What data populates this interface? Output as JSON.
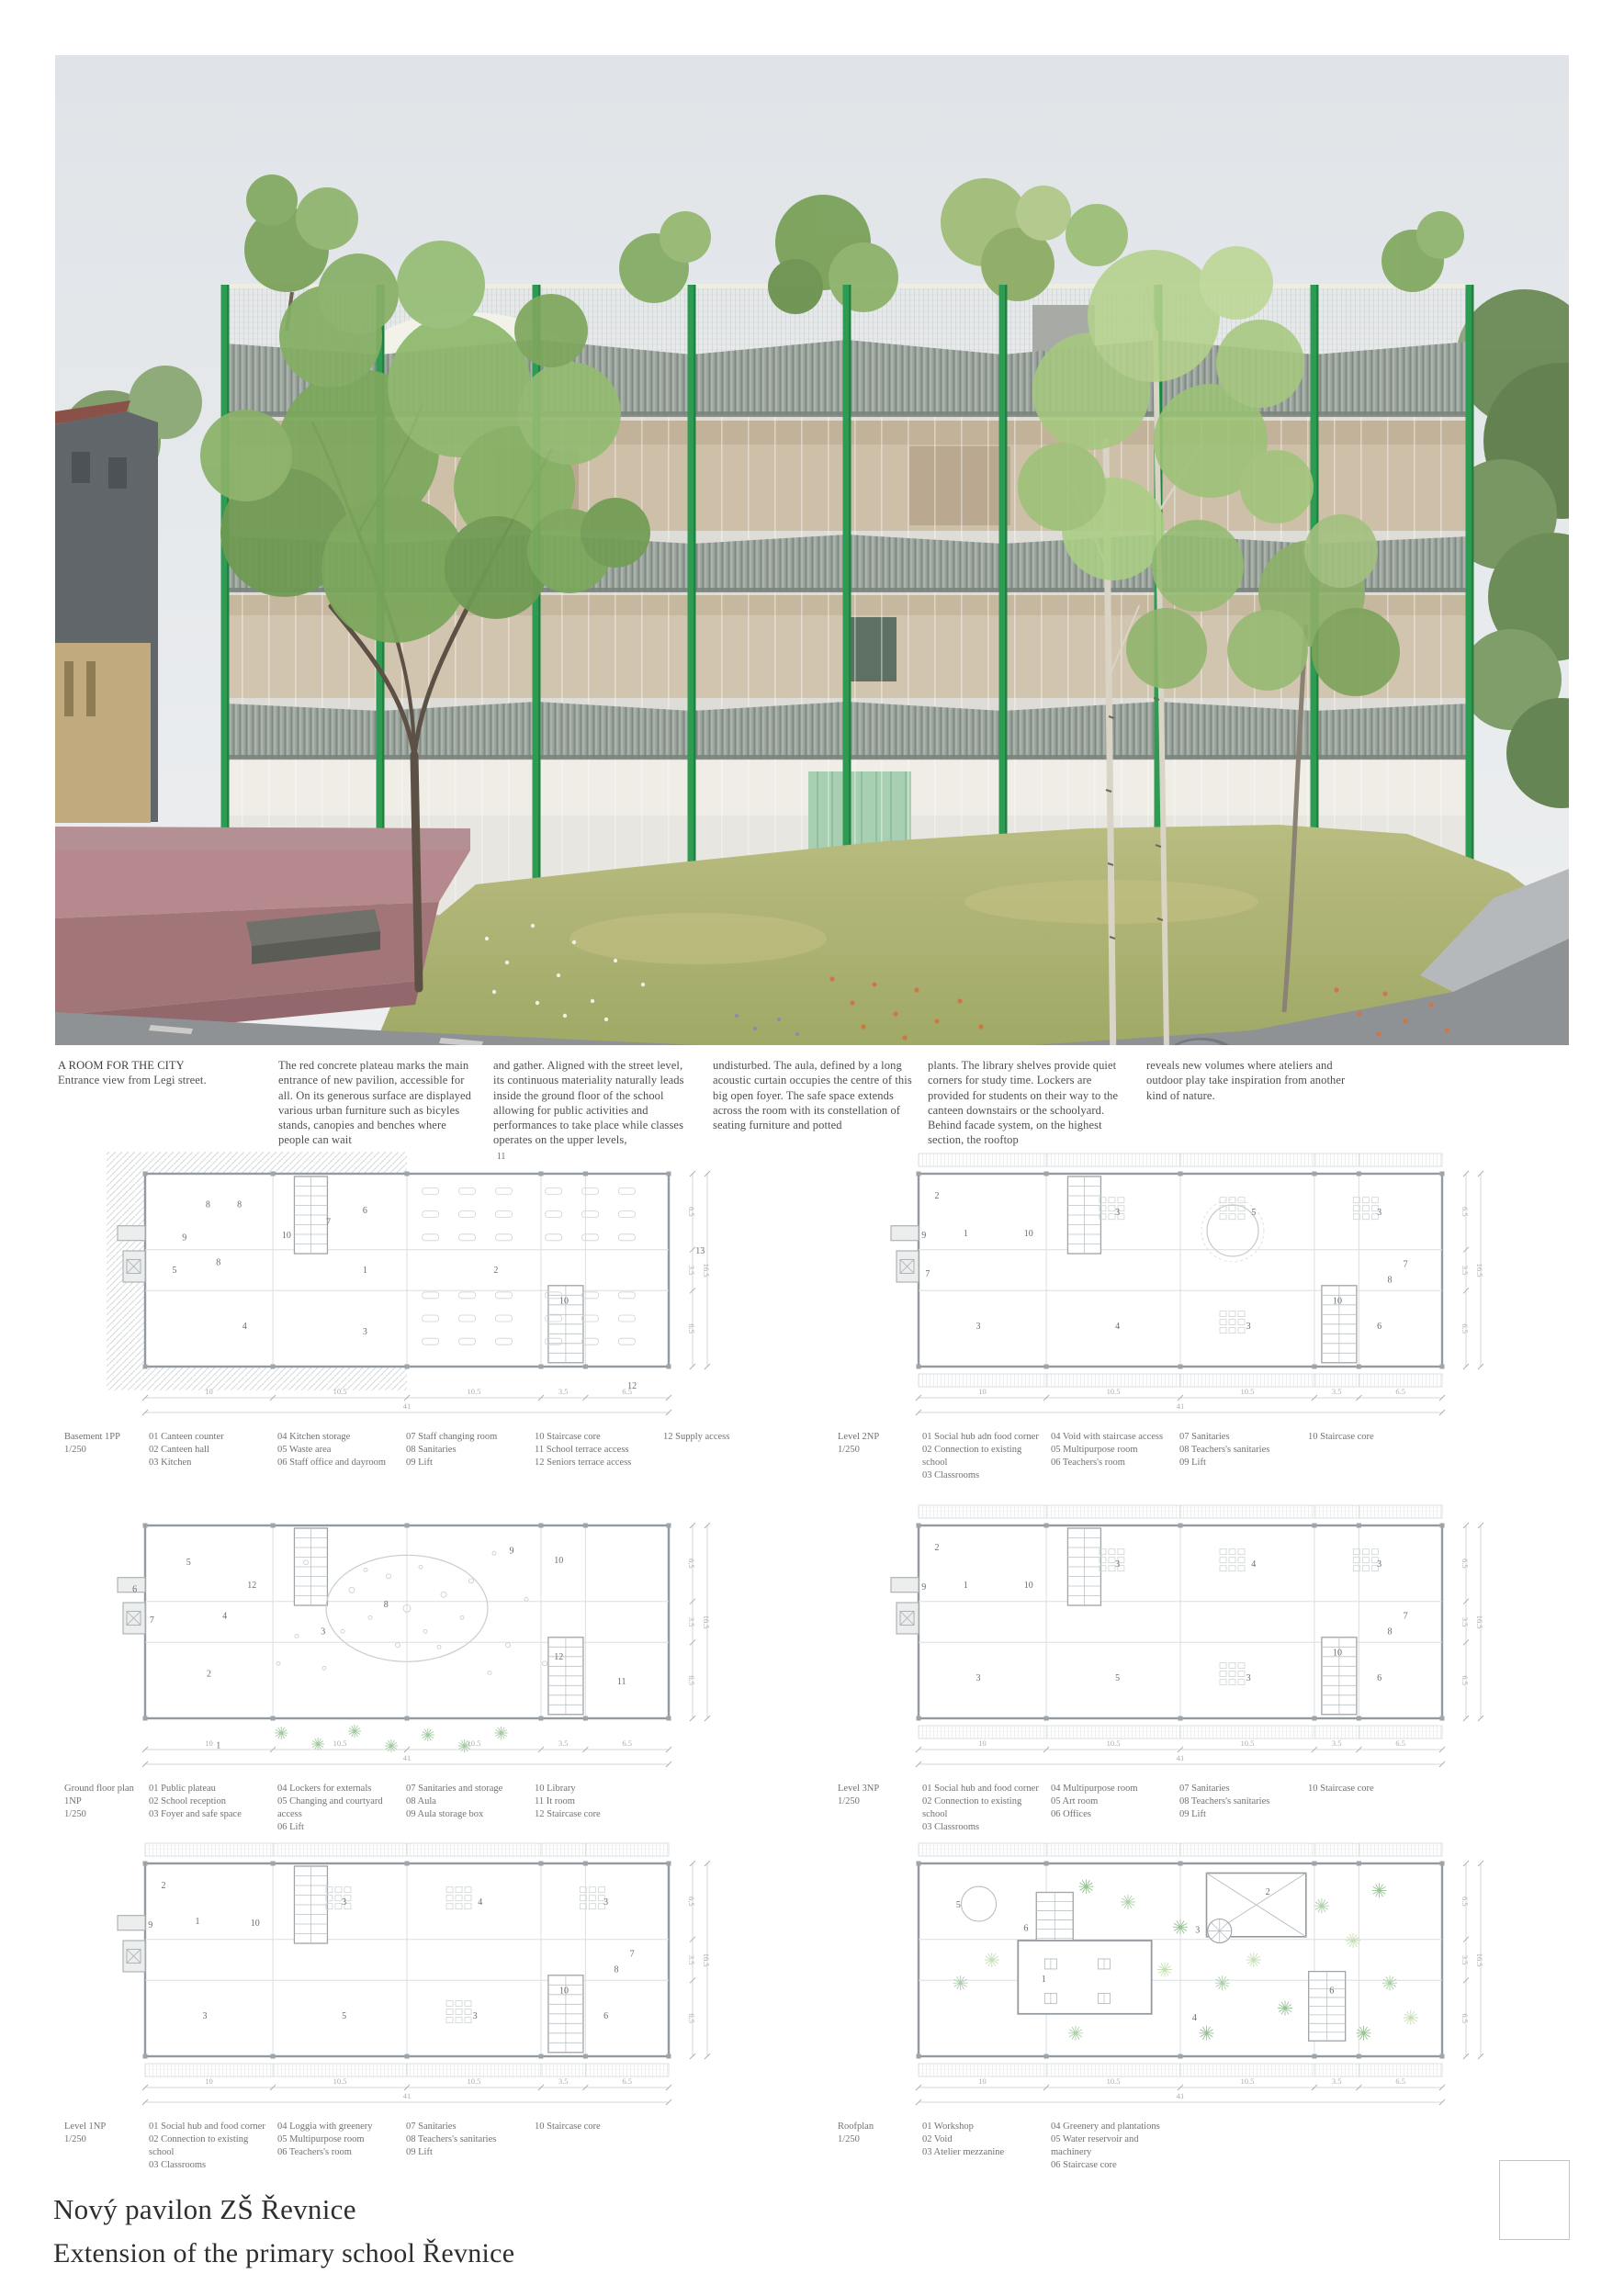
{
  "colors": {
    "structure_green": "#2e9b52",
    "plateau_red": "#b5898e",
    "awning_gray": "#99a29a",
    "grass_green": "#aab06c",
    "sky_gray": "#e0e4e8",
    "text_gray": "#4c4f52"
  },
  "hero": {
    "caption": {
      "title": "A ROOM FOR THE CITY",
      "subtitle": "Entrance view from Legi street."
    },
    "columns": [
      "The red concrete plateau marks the main entrance of new pavilion, accessible for all. On its generous surface are displayed various urban furniture such as bicyles stands, canopies and benches where people can wait",
      "and gather. Aligned with the street level, its continuous materiality naturally leads inside the ground floor of the school allowing for public activities and performances to take place while classes operates on the upper levels,",
      "undisturbed. The aula, defined by a long acoustic curtain occupies the centre of this big open foyer. The safe space extends across the room with its constellation of seating furniture and potted",
      "plants. The library shelves provide quiet corners for study time. Lockers are provided for students on their way to the canteen downstairs or the schoolyard. Behind facade system, on the highest section, the rooftop",
      "reveals new volumes where ateliers and outdoor play take inspiration from another kind of nature."
    ]
  },
  "plans": [
    {
      "label": "Basement 1PP",
      "scale": "1/250",
      "legend": [
        [
          "01 Canteen counter",
          "02 Canteen hall",
          "03 Kitchen"
        ],
        [
          "04 Kitchen storage",
          "05 Waste area",
          "06 Staff office and dayroom"
        ],
        [
          "07 Staff changing room",
          "08 Sanitaries",
          "09 Lift"
        ],
        [
          "10 Staircase core",
          "11 School terrace access",
          "12 Seniors terrace access"
        ],
        [
          "12 Supply access"
        ]
      ],
      "features": [
        "hatch-left",
        "annex-left",
        "stair-left",
        "stair-right",
        "canteen"
      ],
      "rooms": [
        {
          "n": "8",
          "x": 0.12,
          "y": 0.16
        },
        {
          "n": "8",
          "x": 0.18,
          "y": 0.16
        },
        {
          "n": "10",
          "x": 0.27,
          "y": 0.32
        },
        {
          "n": "7",
          "x": 0.35,
          "y": 0.25
        },
        {
          "n": "6",
          "x": 0.42,
          "y": 0.19
        },
        {
          "n": "9",
          "x": 0.075,
          "y": 0.33
        },
        {
          "n": "5",
          "x": 0.056,
          "y": 0.5
        },
        {
          "n": "8",
          "x": 0.14,
          "y": 0.46
        },
        {
          "n": "1",
          "x": 0.42,
          "y": 0.5
        },
        {
          "n": "2",
          "x": 0.67,
          "y": 0.5
        },
        {
          "n": "4",
          "x": 0.19,
          "y": 0.79
        },
        {
          "n": "3",
          "x": 0.42,
          "y": 0.82
        },
        {
          "n": "10",
          "x": 0.8,
          "y": 0.66
        },
        {
          "n": "11",
          "x": 0.68,
          "y": -0.09
        },
        {
          "n": "12",
          "x": 0.93,
          "y": 1.1
        },
        {
          "n": "13",
          "x": 1.06,
          "y": 0.4
        }
      ],
      "dims_bottom": [
        "10",
        "10.5",
        "10.5",
        "3.5",
        "6.5"
      ],
      "dim_total_bottom": "41",
      "dims_right": [
        "6.5",
        "3.5",
        "6.5"
      ],
      "dim_total_right": "16.5"
    },
    {
      "label": "Level 2NP",
      "scale": "1/250",
      "legend": [
        [
          "01 Social hub adn food corner",
          "02 Connection to existing school",
          "03 Classrooms"
        ],
        [
          "04 Void with staircase access",
          "05 Multipurpose room",
          "06 Teachers's room"
        ],
        [
          "07 Sanitaries",
          "08 Teachers's sanitaries",
          "09 Lift"
        ],
        [
          "10 Staircase core"
        ]
      ],
      "features": [
        "awning-bands",
        "annex-left",
        "stair-left",
        "stair-right",
        "desks",
        "void-circle"
      ],
      "rooms": [
        {
          "n": "2",
          "x": 0.035,
          "y": 0.115
        },
        {
          "n": "1",
          "x": 0.09,
          "y": 0.31
        },
        {
          "n": "9",
          "x": 0.01,
          "y": 0.32
        },
        {
          "n": "10",
          "x": 0.21,
          "y": 0.31
        },
        {
          "n": "3",
          "x": 0.38,
          "y": 0.2
        },
        {
          "n": "5",
          "x": 0.64,
          "y": 0.2
        },
        {
          "n": "3",
          "x": 0.88,
          "y": 0.2
        },
        {
          "n": "7",
          "x": 0.017,
          "y": 0.52
        },
        {
          "n": "7",
          "x": 0.93,
          "y": 0.47
        },
        {
          "n": "8",
          "x": 0.9,
          "y": 0.55
        },
        {
          "n": "3",
          "x": 0.114,
          "y": 0.79
        },
        {
          "n": "4",
          "x": 0.38,
          "y": 0.79
        },
        {
          "n": "3",
          "x": 0.63,
          "y": 0.79
        },
        {
          "n": "10",
          "x": 0.8,
          "y": 0.66
        },
        {
          "n": "6",
          "x": 0.88,
          "y": 0.79
        }
      ],
      "dims_bottom": [
        "10",
        "10.5",
        "10.5",
        "3.5",
        "6.5"
      ],
      "dim_total_bottom": "41",
      "dims_right": [
        "6.5",
        "3.5",
        "6.5"
      ],
      "dim_total_right": "16.5"
    },
    {
      "label": "Ground floor plan 1NP",
      "scale": "1/250",
      "legend": [
        [
          "01 Public plateau",
          "02 School reception",
          "03 Foyer and safe space"
        ],
        [
          "04 Lockers for externals",
          "05 Changing and courtyard access",
          "06 Lift"
        ],
        [
          "07 Sanitaries and storage",
          "08 Aula",
          "09 Aula storage box"
        ],
        [
          "10 Library",
          "11 It room",
          "12 Staircase core"
        ]
      ],
      "features": [
        "annex-left",
        "stair-left",
        "stair-right",
        "aula",
        "plants-bottom"
      ],
      "rooms": [
        {
          "n": "5",
          "x": 0.083,
          "y": 0.19
        },
        {
          "n": "6",
          "x": -0.02,
          "y": 0.33
        },
        {
          "n": "7",
          "x": 0.013,
          "y": 0.49
        },
        {
          "n": "12",
          "x": 0.204,
          "y": 0.31
        },
        {
          "n": "4",
          "x": 0.152,
          "y": 0.47
        },
        {
          "n": "2",
          "x": 0.122,
          "y": 0.77
        },
        {
          "n": "3",
          "x": 0.34,
          "y": 0.55
        },
        {
          "n": "8",
          "x": 0.46,
          "y": 0.41
        },
        {
          "n": "9",
          "x": 0.7,
          "y": 0.13
        },
        {
          "n": "10",
          "x": 0.79,
          "y": 0.18
        },
        {
          "n": "12",
          "x": 0.79,
          "y": 0.68
        },
        {
          "n": "11",
          "x": 0.91,
          "y": 0.81
        },
        {
          "n": "1",
          "x": 0.14,
          "y": 1.14
        }
      ],
      "dims_bottom": [
        "10",
        "10.5",
        "10.5",
        "3.5",
        "6.5"
      ],
      "dim_total_bottom": "41",
      "dims_right": [
        "6.5",
        "3.5",
        "6.5"
      ],
      "dim_total_right": "16.5"
    },
    {
      "label": "Level 3NP",
      "scale": "1/250",
      "legend": [
        [
          "01 Social hub and food corner",
          "02 Connection to existing school",
          "03 Classrooms"
        ],
        [
          "04 Multipurpose room",
          "05 Art room",
          "06 Offices"
        ],
        [
          "07 Sanitaries",
          "08 Teachers's sanitaries",
          "09 Lift"
        ],
        [
          "10 Staircase core"
        ]
      ],
      "features": [
        "awning-bands",
        "annex-left",
        "stair-left",
        "stair-right",
        "desks"
      ],
      "rooms": [
        {
          "n": "2",
          "x": 0.035,
          "y": 0.115
        },
        {
          "n": "1",
          "x": 0.09,
          "y": 0.31
        },
        {
          "n": "9",
          "x": 0.01,
          "y": 0.32
        },
        {
          "n": "10",
          "x": 0.21,
          "y": 0.31
        },
        {
          "n": "3",
          "x": 0.38,
          "y": 0.2
        },
        {
          "n": "4",
          "x": 0.64,
          "y": 0.2
        },
        {
          "n": "3",
          "x": 0.88,
          "y": 0.2
        },
        {
          "n": "7",
          "x": 0.93,
          "y": 0.47
        },
        {
          "n": "8",
          "x": 0.9,
          "y": 0.55
        },
        {
          "n": "3",
          "x": 0.114,
          "y": 0.79
        },
        {
          "n": "5",
          "x": 0.38,
          "y": 0.79
        },
        {
          "n": "3",
          "x": 0.63,
          "y": 0.79
        },
        {
          "n": "10",
          "x": 0.8,
          "y": 0.66
        },
        {
          "n": "6",
          "x": 0.88,
          "y": 0.79
        }
      ],
      "dims_bottom": [
        "10",
        "10.5",
        "10.5",
        "3.5",
        "6.5"
      ],
      "dim_total_bottom": "41",
      "dims_right": [
        "6.5",
        "3.5",
        "6.5"
      ],
      "dim_total_right": "16.5"
    },
    {
      "label": "Level 1NP",
      "scale": "1/250",
      "legend": [
        [
          "01 Social hub and food corner",
          "02 Connection to existing school",
          "03 Classrooms"
        ],
        [
          "04 Loggia with greenery",
          "05 Multipurpose room",
          "06 Teachers's room"
        ],
        [
          "07 Sanitaries",
          "08 Teachers's sanitaries",
          "09 Lift"
        ],
        [
          "10 Staircase core"
        ]
      ],
      "features": [
        "awning-bands",
        "annex-left",
        "stair-left",
        "stair-right",
        "desks"
      ],
      "rooms": [
        {
          "n": "2",
          "x": 0.035,
          "y": 0.115
        },
        {
          "n": "1",
          "x": 0.1,
          "y": 0.3
        },
        {
          "n": "9",
          "x": 0.01,
          "y": 0.32
        },
        {
          "n": "10",
          "x": 0.21,
          "y": 0.31
        },
        {
          "n": "3",
          "x": 0.38,
          "y": 0.2
        },
        {
          "n": "4",
          "x": 0.64,
          "y": 0.2
        },
        {
          "n": "3",
          "x": 0.88,
          "y": 0.2
        },
        {
          "n": "7",
          "x": 0.93,
          "y": 0.47
        },
        {
          "n": "8",
          "x": 0.9,
          "y": 0.55
        },
        {
          "n": "3",
          "x": 0.114,
          "y": 0.79
        },
        {
          "n": "5",
          "x": 0.38,
          "y": 0.79
        },
        {
          "n": "3",
          "x": 0.63,
          "y": 0.79
        },
        {
          "n": "10",
          "x": 0.8,
          "y": 0.66
        },
        {
          "n": "6",
          "x": 0.88,
          "y": 0.79
        }
      ],
      "dims_bottom": [
        "10",
        "10.5",
        "10.5",
        "3.5",
        "6.5"
      ],
      "dim_total_bottom": "41",
      "dims_right": [
        "6.5",
        "3.5",
        "6.5"
      ],
      "dim_total_right": "16.5"
    },
    {
      "label": "Roofplan",
      "scale": "1/250",
      "legend": [
        [
          "01 Workshop",
          "02 Void",
          "03 Atelier mezzanine"
        ],
        [
          "04 Greenery and plantations",
          "05 Water reservoir and machinery",
          "06 Staircase core"
        ]
      ],
      "features": [
        "awning-bands",
        "roof-garden",
        "workshop",
        "void-x",
        "spiral-stair",
        "reservoir",
        "stair-roof-left",
        "stair-roof-right"
      ],
      "rooms": [
        {
          "n": "5",
          "x": 0.076,
          "y": 0.215
        },
        {
          "n": "6",
          "x": 0.205,
          "y": 0.335
        },
        {
          "n": "1",
          "x": 0.239,
          "y": 0.6
        },
        {
          "n": "2",
          "x": 0.667,
          "y": 0.147
        },
        {
          "n": "3",
          "x": 0.533,
          "y": 0.346
        },
        {
          "n": "4",
          "x": 0.527,
          "y": 0.8
        },
        {
          "n": "6",
          "x": 0.789,
          "y": 0.66
        }
      ],
      "dims_bottom": [
        "10",
        "10.5",
        "10.5",
        "3.5",
        "6.5"
      ],
      "dim_total_bottom": "41",
      "dims_right": [
        "6.5",
        "3.5",
        "6.5"
      ],
      "dim_total_right": "16.5"
    }
  ],
  "footer": {
    "title_cs": "Nový pavilon ZŠ Řevnice",
    "title_en": "Extension of the primary school Řevnice"
  }
}
